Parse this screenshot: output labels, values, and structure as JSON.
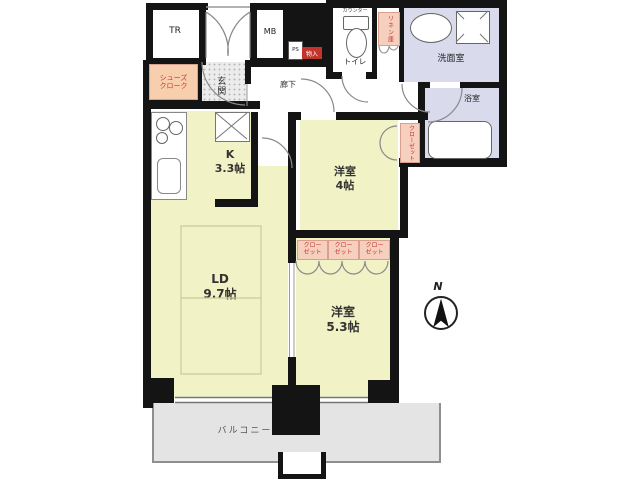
{
  "floor_plan": {
    "labels": {
      "tr": "TR",
      "mb": "MB",
      "ps": "PS",
      "monoire": "物入",
      "counter": "カウンター",
      "toilet": "トイレ",
      "linen": "リネン庫",
      "washroom": "洗面室",
      "bathroom": "浴室",
      "shoes": "シューズ\nクローク",
      "entrance": "玄関",
      "hallway": "廊下",
      "kitchen": "K\n3.3帖",
      "room4": "洋室\n4帖",
      "living": "LD\n9.7帖",
      "room53": "洋室\n5.3帖",
      "closet": "クロー\nゼット",
      "closet_vertical": "クローゼット",
      "balcony": "バルコニー",
      "north": "N"
    },
    "colors": {
      "wall": "#141414",
      "room": "#f1f3c6",
      "wet": "#d9daeb",
      "balcony": "#e4e4e4",
      "label_pink": "#f7cfbe",
      "label_red": "#c2342c",
      "shoes_pink": "#f7cfae"
    }
  }
}
